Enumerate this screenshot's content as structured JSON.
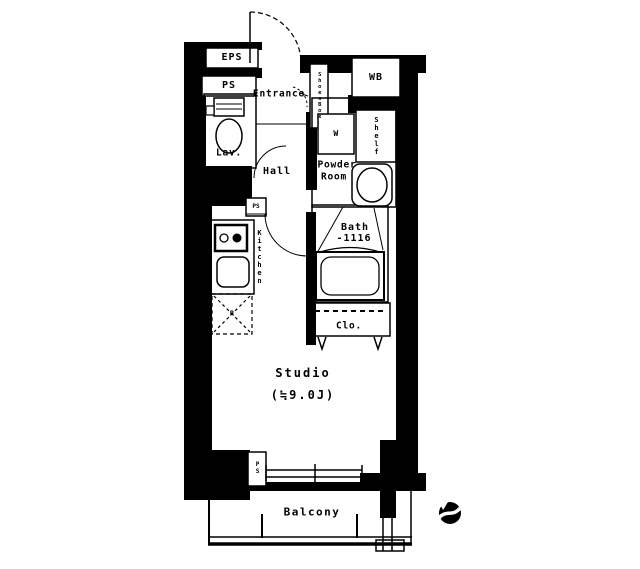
{
  "plan": {
    "type": "apartment-floor-plan",
    "labels": {
      "eps": "EPS",
      "ps_top": "PS",
      "lav": "Lav.",
      "entrance": "Entrance",
      "shoes_box": "ShoesBox",
      "wb": "WB",
      "washer": "W",
      "shelf": "Shelf",
      "powder_line1": "Powder",
      "powder_line2": "Room",
      "hall": "Hall",
      "ps_mid": "PS",
      "kitchen": "Kitchen",
      "fridge": "R",
      "bath_line1": "Bath",
      "bath_line2": "-1116",
      "closet": "Clo.",
      "studio_line1": "Studio",
      "studio_line2": "(≒9.0J)",
      "ps_bottom": "PS",
      "balcony": "Balcony"
    },
    "icons": {
      "north_arrow": "north-arrow"
    },
    "colors": {
      "wall": "#000000",
      "background": "#ffffff",
      "line": "#000000"
    }
  }
}
